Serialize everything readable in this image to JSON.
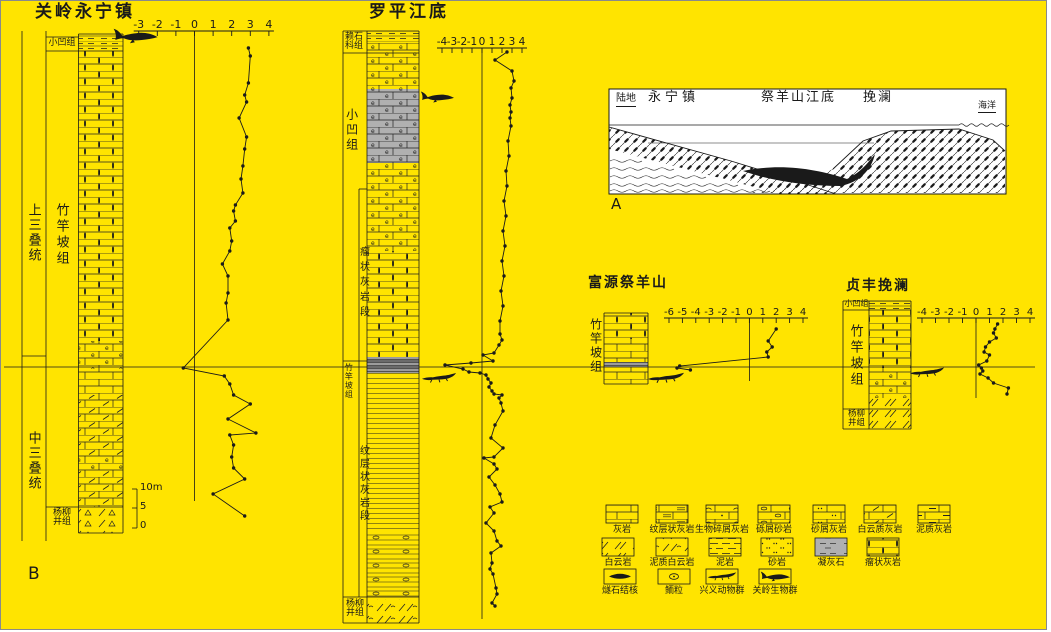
{
  "colors": {
    "background": "#FFE400",
    "ink": "#1A1A1A",
    "gray_band": "#9C9C9C",
    "gray_cells": "#B0B0B0"
  },
  "panels": {
    "a_label": "A",
    "b_label": "B"
  },
  "sections": {
    "guanling": {
      "title": "关岭永宁镇",
      "era_upper": "上三叠统",
      "era_lower": "中三叠统",
      "fm_xiaowa": "小凹组",
      "fm_zhuganpo": "竹竿坡组",
      "fm_yangliujing": "杨柳\n井组",
      "scale_bar": {
        "top": "10m",
        "mid": "5",
        "bottom": "0"
      }
    },
    "luoping": {
      "title": "罗平江底",
      "fm_laishike": "赖石\n科组",
      "fm_xiaowa": "小凹组",
      "member_nodular": "瘤状灰岩段",
      "fm_zhuganpo": "竹竿坡组",
      "member_laminated": "纹层状灰岩段",
      "fm_yangliujing": "杨柳\n井组"
    },
    "cross_section": {
      "land": "陆地",
      "loc_yongning": "永宁镇",
      "loc_jiyangshan_jiangdi": "祭羊山江底",
      "loc_wanlan": "挽澜",
      "sea": "海洋"
    },
    "fuyuan": {
      "title": "富源祭羊山",
      "fm_zhuganpo": "竹竿坡组"
    },
    "zhenfeng": {
      "title": "贞丰挽澜",
      "fm_xiaowa": "小凹组",
      "fm_zhuganpo": "竹竿坡组",
      "fm_yangliujing": "杨柳\n井组"
    }
  },
  "legend": {
    "rows": [
      [
        {
          "label": "灰岩",
          "pattern": "brick"
        },
        {
          "label": "纹层状灰岩",
          "pattern": "brick-laminated"
        },
        {
          "label": "生物碎屑灰岩",
          "pattern": "brick-bioclast"
        },
        {
          "label": "砾屑砂岩",
          "pattern": "brick-gravel"
        },
        {
          "label": "砂屑灰岩",
          "pattern": "brick-sand"
        },
        {
          "label": "白云质灰岩",
          "pattern": "brick-dolomitic"
        },
        {
          "label": "泥质灰岩",
          "pattern": "brick-argillaceous"
        }
      ],
      [
        {
          "label": "白云岩",
          "pattern": "slashes"
        },
        {
          "label": "泥质白云岩",
          "pattern": "slash-argillaceous"
        },
        {
          "label": "泥岩",
          "pattern": "mud-dashes"
        },
        {
          "label": "砂岩",
          "pattern": "sand-dots"
        },
        {
          "label": "凝灰石",
          "pattern": "tuff-gray"
        },
        {
          "label": "瘤状灰岩",
          "pattern": "brick-nodular"
        }
      ],
      [
        {
          "label": "燧石结核",
          "pattern": "chert-nodule"
        },
        {
          "label": "鲕粒",
          "pattern": "ooid"
        },
        {
          "label": "兴义动物群",
          "pattern": "croc-icon"
        },
        {
          "label": "关岭生物群",
          "pattern": "ichthyosaur-icon"
        }
      ]
    ]
  },
  "chart_data": {
    "type": "line",
    "orientation": "vertical-profile",
    "note": "Isotope-style curves plotted beside stratigraphic columns; each point is [axis value, vertical pixel position]",
    "charts": [
      {
        "section": "guanling",
        "title": "关岭永宁镇",
        "axis_ticks": [
          -3,
          -2,
          -1,
          0,
          1,
          2,
          3,
          4
        ],
        "points": [
          [
            2.9,
            47
          ],
          [
            3.0,
            55
          ],
          [
            2.9,
            82
          ],
          [
            2.7,
            94
          ],
          [
            2.8,
            101
          ],
          [
            2.4,
            117
          ],
          [
            2.8,
            136
          ],
          [
            2.7,
            148
          ],
          [
            2.6,
            165
          ],
          [
            2.5,
            178
          ],
          [
            2.6,
            192
          ],
          [
            2.2,
            204
          ],
          [
            2.1,
            210
          ],
          [
            2.2,
            220
          ],
          [
            1.9,
            227
          ],
          [
            2.0,
            240
          ],
          [
            1.9,
            250
          ],
          [
            1.5,
            263
          ],
          [
            1.8,
            275
          ],
          [
            1.8,
            292
          ],
          [
            1.7,
            302
          ],
          [
            1.8,
            319
          ],
          [
            -0.6,
            367
          ],
          [
            1.6,
            375
          ],
          [
            1.9,
            383
          ],
          [
            2.1,
            394
          ],
          [
            3.0,
            403
          ],
          [
            1.8,
            418
          ],
          [
            3.3,
            432
          ],
          [
            1.9,
            434
          ],
          [
            2.1,
            444
          ],
          [
            2.0,
            456
          ],
          [
            2.1,
            467
          ],
          [
            2.7,
            478
          ],
          [
            1.0,
            493
          ],
          [
            2.7,
            515
          ]
        ]
      },
      {
        "section": "luoping",
        "title": "罗平江底",
        "axis_ticks": [
          -4,
          -3,
          -2,
          -1,
          0,
          1,
          2,
          3,
          4
        ],
        "points": [
          [
            2.5,
            51
          ],
          [
            1.3,
            59
          ],
          [
            3.0,
            70
          ],
          [
            3.2,
            80
          ],
          [
            2.9,
            87
          ],
          [
            3.0,
            97
          ],
          [
            2.8,
            104
          ],
          [
            2.9,
            111
          ],
          [
            2.8,
            117
          ],
          [
            2.9,
            125
          ],
          [
            2.6,
            140
          ],
          [
            2.7,
            155
          ],
          [
            2.4,
            170
          ],
          [
            2.5,
            185
          ],
          [
            2.2,
            200
          ],
          [
            2.4,
            215
          ],
          [
            2.1,
            230
          ],
          [
            2.3,
            245
          ],
          [
            2.0,
            260
          ],
          [
            2.2,
            275
          ],
          [
            1.9,
            290
          ],
          [
            2.1,
            305
          ],
          [
            1.8,
            320
          ],
          [
            1.8,
            333
          ],
          [
            2.0,
            339
          ],
          [
            1.7,
            344
          ],
          [
            1.2,
            352
          ],
          [
            0.1,
            354
          ],
          [
            1.1,
            360
          ],
          [
            -1.1,
            362
          ],
          [
            -3.7,
            364
          ],
          [
            -1.9,
            368
          ],
          [
            -1.3,
            371
          ],
          [
            -0.2,
            372
          ],
          [
            0.4,
            374
          ],
          [
            0.6,
            378
          ],
          [
            0.9,
            382
          ],
          [
            0.7,
            386
          ],
          [
            1.0,
            390
          ],
          [
            1.2,
            393
          ],
          [
            2.0,
            394
          ],
          [
            1.7,
            397
          ],
          [
            1.9,
            402
          ],
          [
            2.1,
            410
          ],
          [
            1.3,
            424
          ],
          [
            0.9,
            437
          ],
          [
            2.1,
            447
          ],
          [
            1.2,
            456
          ],
          [
            0.2,
            457
          ],
          [
            1.2,
            463
          ],
          [
            1.5,
            468
          ],
          [
            0.7,
            476
          ],
          [
            1.3,
            484
          ],
          [
            1.8,
            493
          ],
          [
            2.0,
            501
          ],
          [
            0.8,
            506
          ],
          [
            1.2,
            512
          ],
          [
            0.4,
            522
          ],
          [
            1.2,
            530
          ],
          [
            1.5,
            540
          ],
          [
            1.9,
            545
          ],
          [
            0.9,
            552
          ],
          [
            1.0,
            562
          ],
          [
            0.8,
            568
          ],
          [
            1.1,
            573
          ],
          [
            1.4,
            587
          ],
          [
            1.5,
            593
          ],
          [
            1.0,
            602
          ],
          [
            1.3,
            605
          ]
        ]
      },
      {
        "section": "fuyuan",
        "title": "富源祭羊山",
        "axis_ticks": [
          -6,
          -5,
          -4,
          -3,
          -2,
          -1,
          0,
          1,
          2,
          3,
          4
        ],
        "points": [
          [
            2.0,
            328
          ],
          [
            1.4,
            340
          ],
          [
            1.7,
            346
          ],
          [
            1.3,
            351
          ],
          [
            1.4,
            356
          ],
          [
            -5.2,
            365
          ],
          [
            -5.4,
            367
          ],
          [
            -4.4,
            369
          ]
        ]
      },
      {
        "section": "zhenfeng",
        "title": "贞丰挽澜",
        "axis_ticks": [
          -4,
          -3,
          -2,
          -1,
          0,
          1,
          2,
          3,
          4
        ],
        "points": [
          [
            1.6,
            323
          ],
          [
            1.4,
            328
          ],
          [
            1.3,
            332
          ],
          [
            1.5,
            337
          ],
          [
            1.0,
            341
          ],
          [
            0.7,
            346
          ],
          [
            0.6,
            351
          ],
          [
            1.0,
            354
          ],
          [
            0.8,
            360
          ],
          [
            0.2,
            364
          ],
          [
            0.4,
            367
          ],
          [
            0.5,
            370
          ],
          [
            0.3,
            373
          ],
          [
            0.9,
            377
          ],
          [
            1.3,
            382
          ],
          [
            2.4,
            387
          ],
          [
            2.3,
            393
          ]
        ]
      }
    ]
  }
}
